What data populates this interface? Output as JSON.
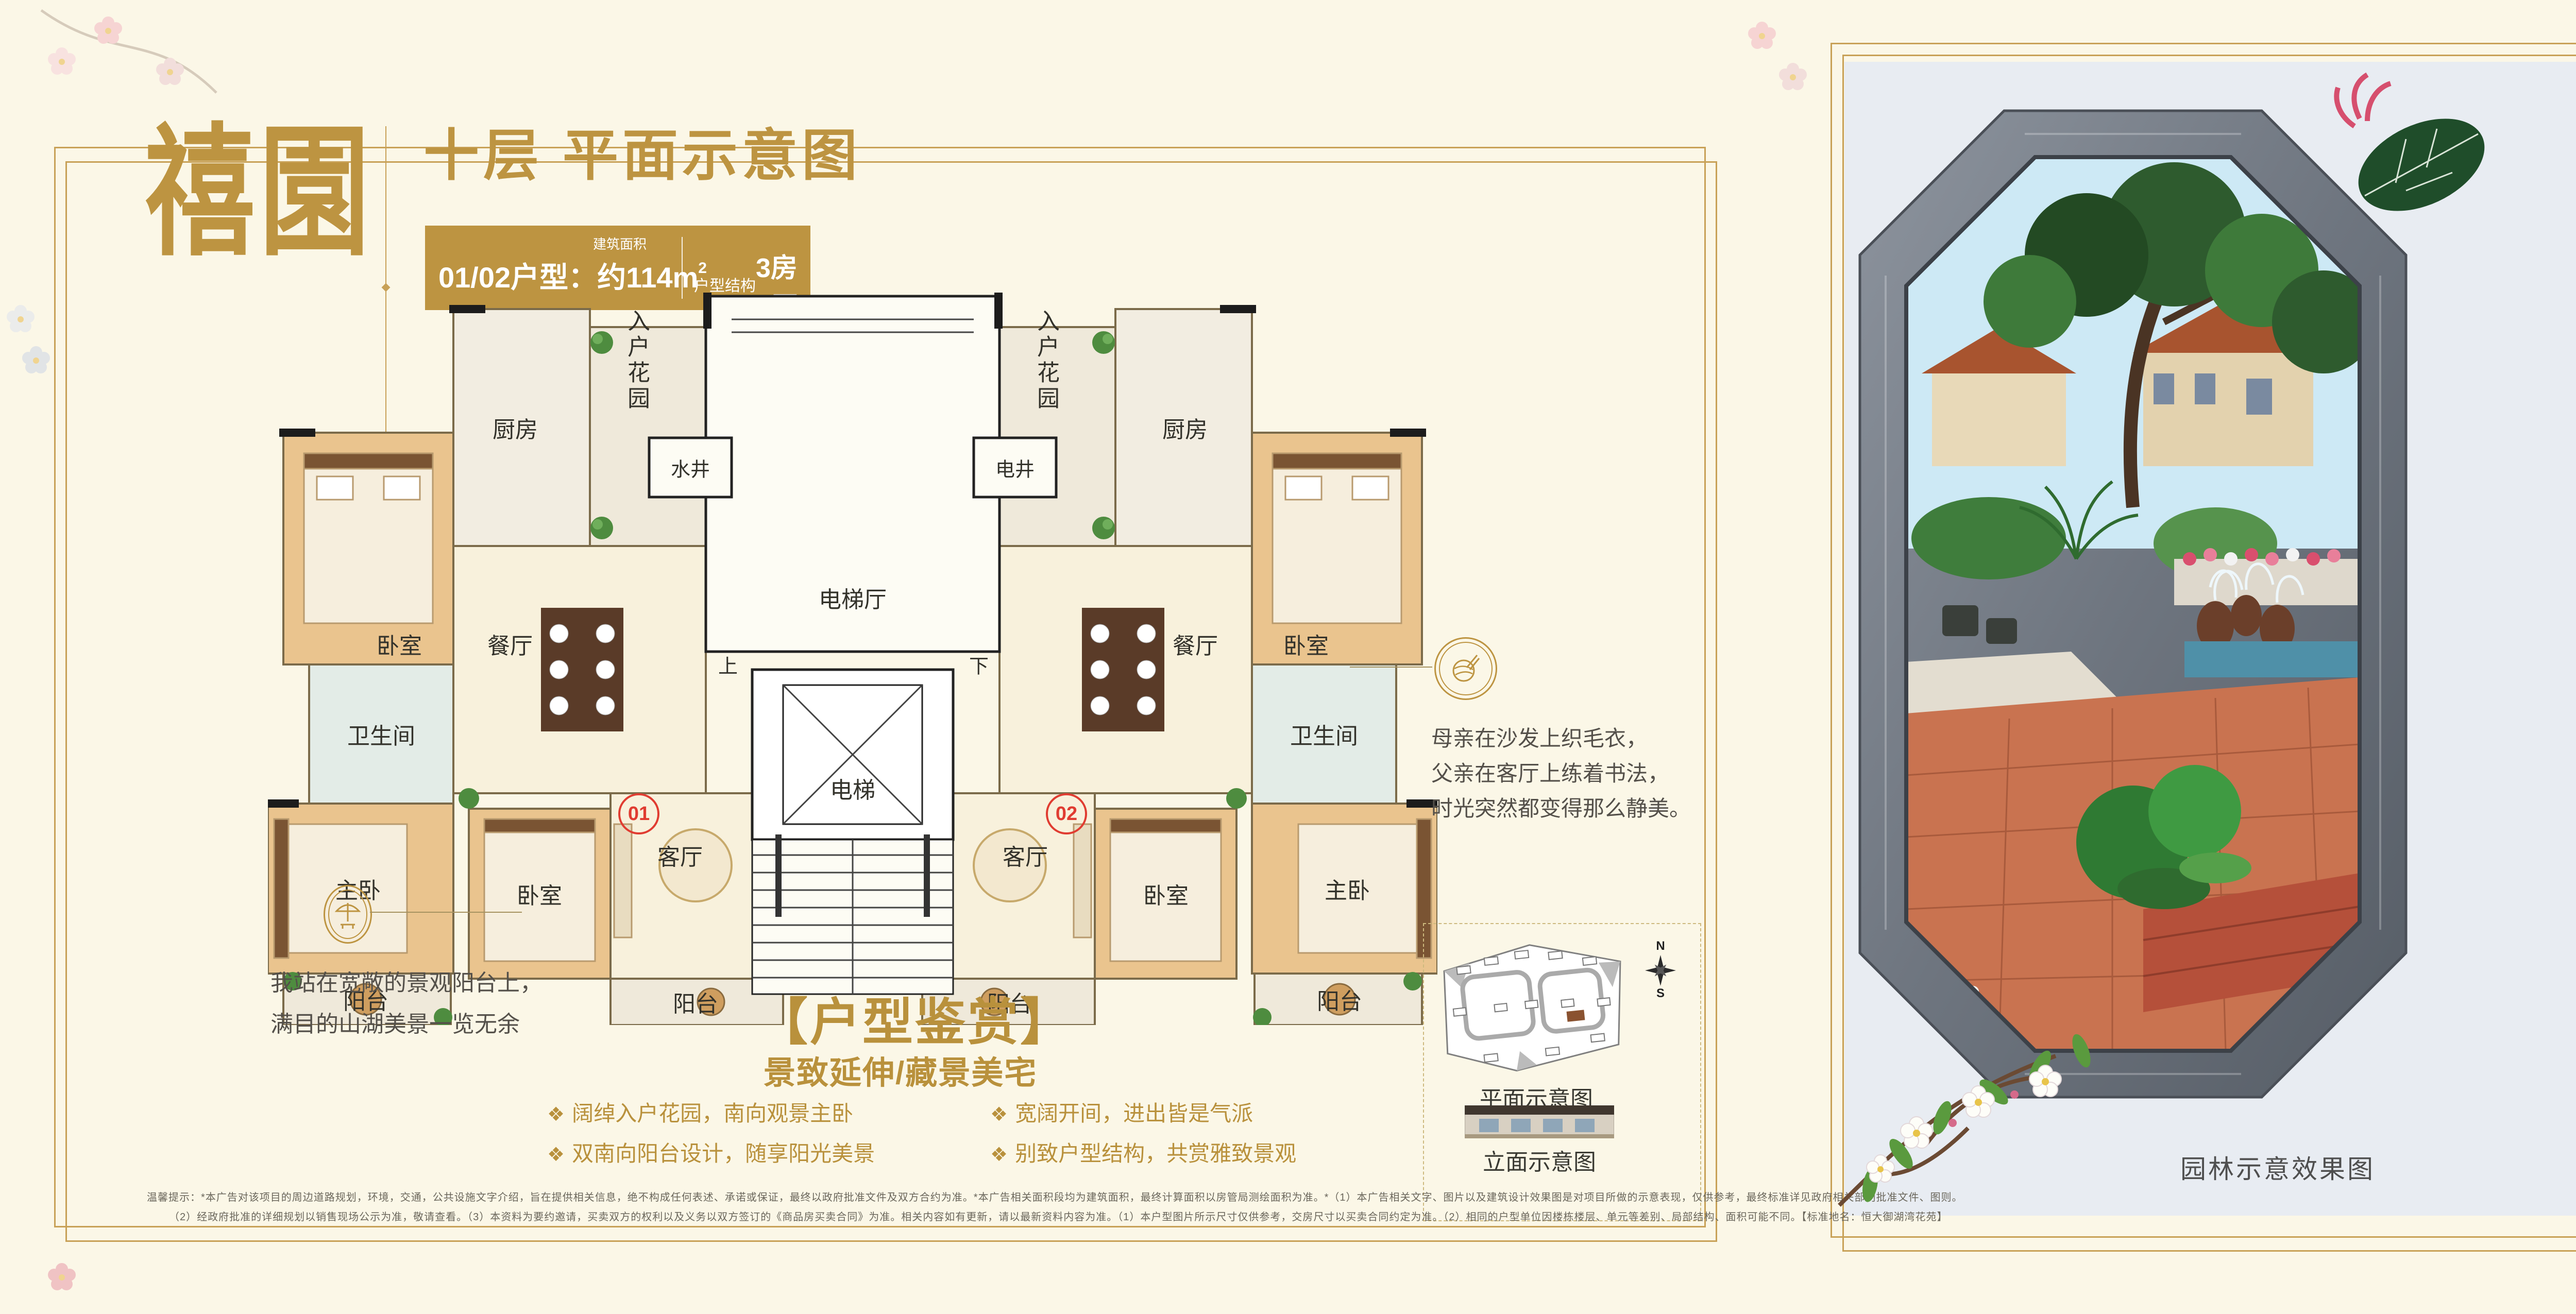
{
  "left_page": {
    "logo": "禧園",
    "title": "十层 平面示意图",
    "banner": {
      "prefix": "01/02户型：约",
      "area_value": "114m",
      "area_sup": "2",
      "area_note": "建筑面积",
      "struct_label": "户型结构",
      "struct_value": "3房2厅1卫"
    },
    "floorplan": {
      "elevator_hall": "电梯厅",
      "water_well": "水井",
      "elec_well": "电井",
      "elevator": "电梯",
      "up": "上",
      "down": "下",
      "kitchen": "厨房",
      "entry_garden": "入户花园",
      "dining": "餐厅",
      "bedroom": "卧室",
      "bathroom": "卫生间",
      "master": "主卧",
      "living": "客厅",
      "balcony": "阳台",
      "unit1": "01",
      "unit2": "02"
    },
    "callout_left": {
      "line1": "我站在宽敞的景观阳台上，",
      "line2": "满目的山湖美景一览无余"
    },
    "callout_right": {
      "line1": "母亲在沙发上织毛衣，",
      "line2": "父亲在客厅上练着书法，",
      "line3": "时光突然都变得那么静美。"
    },
    "appreciation": {
      "title": "【户型鉴赏】",
      "subtitle": "景致延伸/藏景美宅",
      "bullets": [
        "阔绰入户花园，南向观景主卧",
        "双南向阳台设计，随享阳光美景",
        "宽阔开间，进出皆是气派",
        "别致户型结构，共赏雅致景观"
      ]
    },
    "minimap": {
      "site_label": "平面示意图",
      "elevation_label": "立面示意图",
      "north": "N",
      "south": "S"
    },
    "disclaimer_line1": "温馨提示：*本广告对该项目的周边道路规划，环境，交通，公共设施文字介绍，旨在提供相关信息，绝不构成任何表述、承诺或保证，最终以政府批准文件及双方合约为准。*本广告相关面积段均为建筑面积，最终计算面积以房管局测绘面积为准。*（1）本广告相关文字、图片以及建筑设计效果图是对项目所做的示意表现，仅供参考，最终标准详见政府相关部门批准文件、图则。",
    "disclaimer_line2": "（2）经政府批准的详细规划以销售现场公示为准，敬请查看。（3）本资料为要约邀请，买卖双方的权利以及义务以双方签订的《商品房买卖合同》为准。相关内容如有更新，请以最新资料内容为准。（1）本户型图片所示尺寸仅供参考，交房尺寸以买卖合同约定为准。（2）相同的户型单位因楼栋楼层、单元等差别、局部结构、面积可能不同。【标准地名：恒大御湖湾花苑】"
  },
  "right_page": {
    "caption": "园林示意效果图",
    "features": [
      {
        "seal": "梵",
        "lines": [
          "千年西樵山",
          "百年山湖居"
        ]
      },
      {
        "seal": "繁",
        "lines": [
          "四大高速",
          "融双城浮世繁华"
        ]
      },
      {
        "seal": "园",
        "lines": [
          "约9万m²新中式叠水园林",
          "满城秀色映山湖"
        ]
      },
      {
        "seal": "礼",
        "lines": [
          "金碧物业",
          "谨致生活礼遇"
        ]
      }
    ],
    "logo": {
      "brand": "恒大",
      "name": "御湖湾",
      "tagline_left": "西樵山·听音湖",
      "tagline_right": "山水生态美宅",
      "english": "AZURE LAKE GRAND CITY",
      "seal": "禧園"
    }
  },
  "colors": {
    "gold": "#bd9441",
    "frame_gold": "#c8a157",
    "cream": "#fbf7e7",
    "panel_blue": "#e8ecf2",
    "seal_navy": "#232f52",
    "marker_red": "#e03c31"
  }
}
